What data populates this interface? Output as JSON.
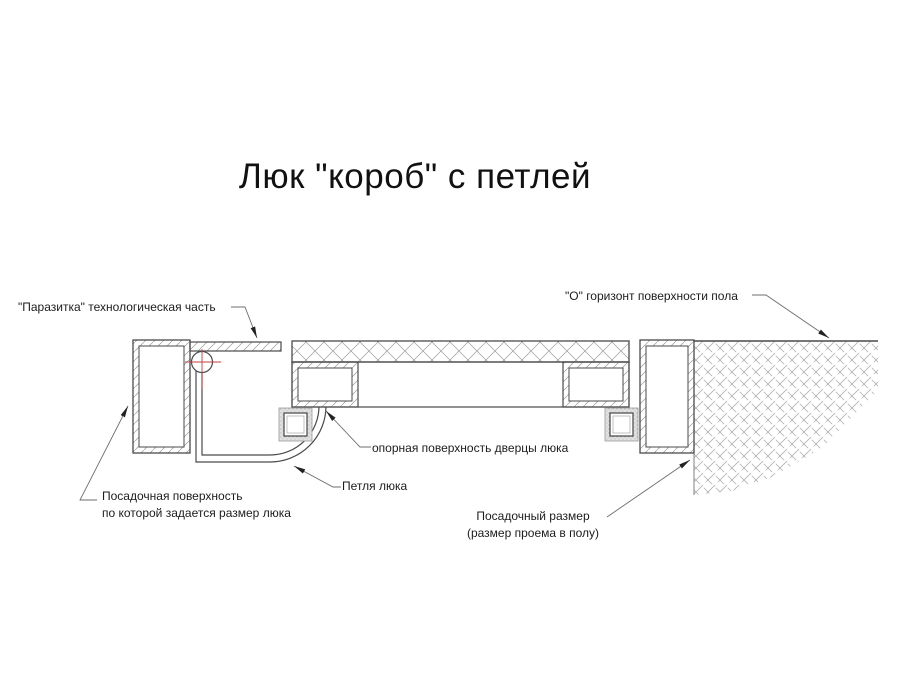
{
  "title": "Люк \"короб\" с петлей",
  "labels": {
    "parazitka": "\"Паразитка\" технологическая часть",
    "floor_horizon": "\"О\" горизонт поверхности пола",
    "door_support": "опорная поверхность дверцы люка",
    "hinge": "Петля люка",
    "seating_surface_line1": "Посадочная поверхность",
    "seating_surface_line2": "по которой задается размер люка",
    "seating_size_line1": "Посадочный размер",
    "seating_size_line2": "(размер проема в полу)"
  },
  "colors": {
    "outline": "#4a4a4a",
    "hatch": "#9c9c9c",
    "floor_hatch": "#b2b2b2",
    "leader": "#6e6e6e",
    "arrow": "#222222",
    "center_mark_red": "#c04040",
    "background": "#ffffff",
    "text": "#1c1c1c"
  }
}
